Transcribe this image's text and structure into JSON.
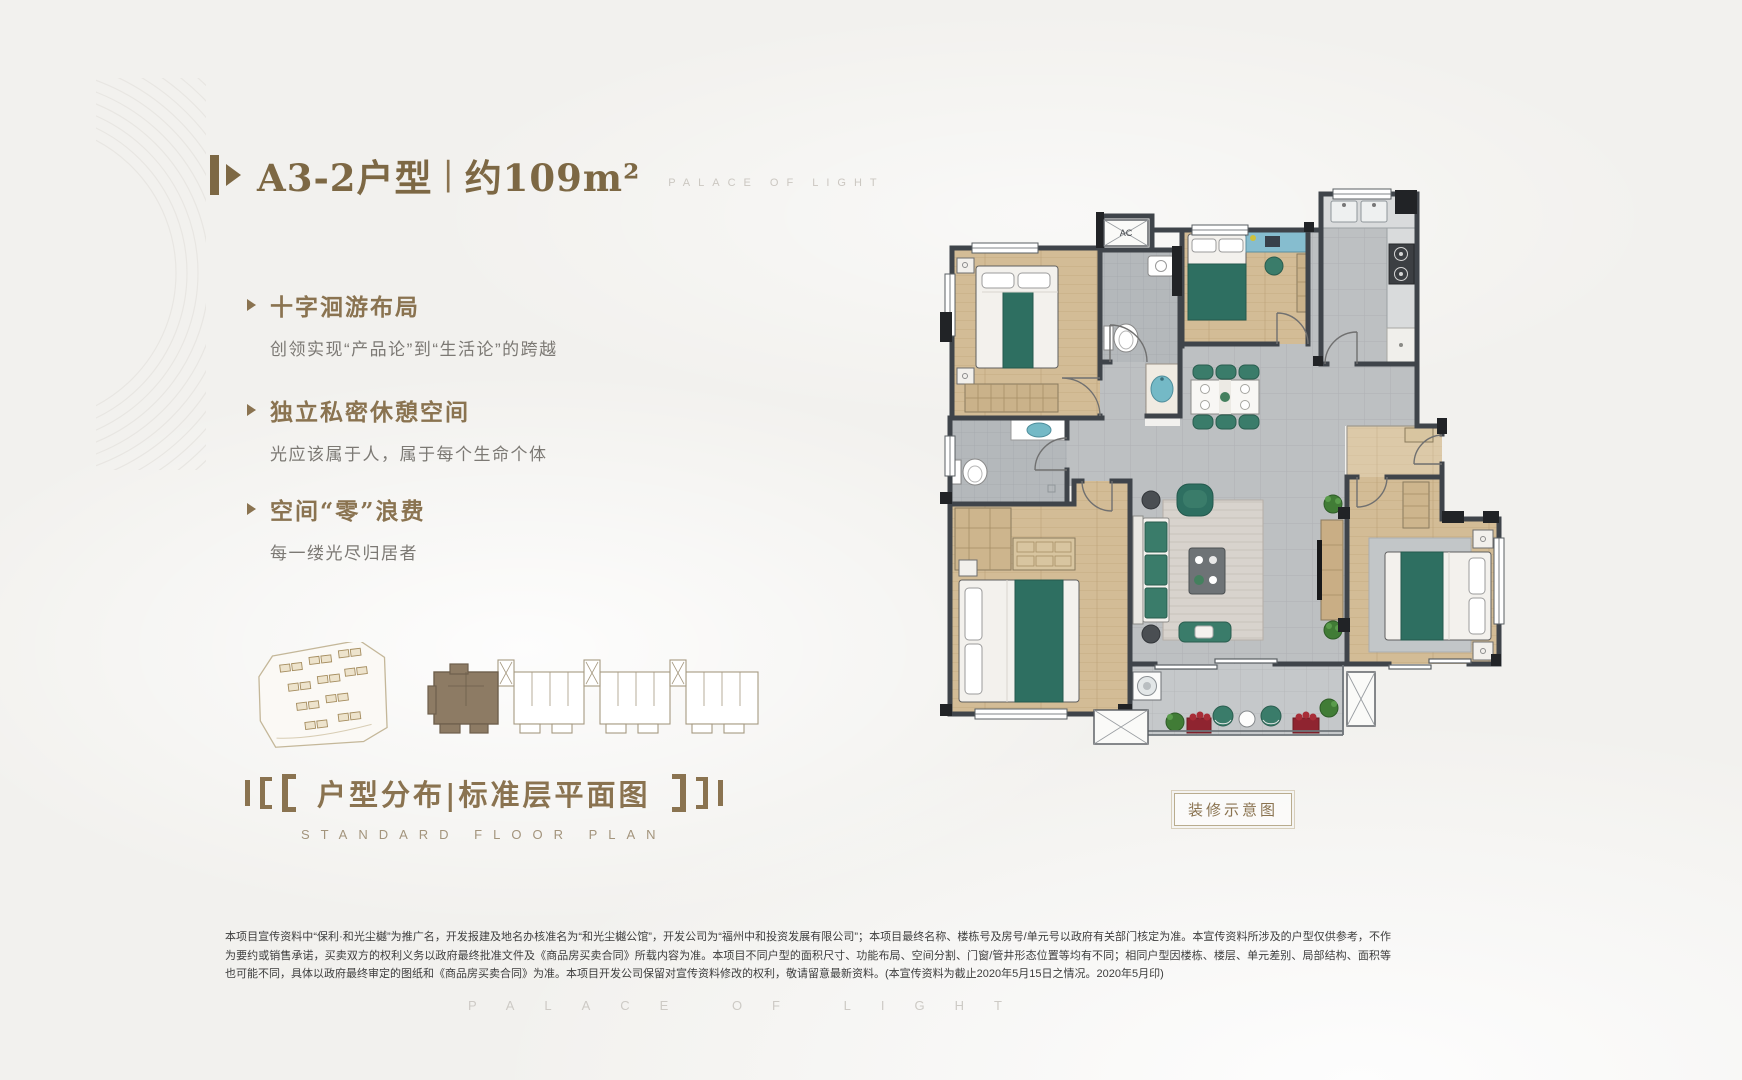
{
  "colors": {
    "accent_gold": "#8a7350",
    "title_gold": "#7d6844",
    "teal_furniture": "#2e6f61",
    "wood_floor": "#d3bc96",
    "tile_floor": "#bdc0c2",
    "wall_gray": "#3f444a",
    "highlight_unit_brown": "#8d7b64",
    "counter_blue": "#86bdcf",
    "planter_red": "#8f2430",
    "background": "#f2f1ee"
  },
  "header": {
    "unit_name": "A3-2户型",
    "divider": "|",
    "area": "约109m²",
    "brand_caption": "PALACE OF LIGHT"
  },
  "features": [
    {
      "title": "十字洄游布局",
      "desc": "创领实现“产品论”到“生活论”的跨越"
    },
    {
      "title": "独立私密休憩空间",
      "desc": "光应该属于人，属于每个生命个体"
    },
    {
      "title": "空间“零”浪费",
      "desc": "每一缕光尽归居者"
    }
  ],
  "section_heading": {
    "title_cn": "户型分布|标准层平面图",
    "title_en": "STANDARD FLOOR PLAN"
  },
  "floor_plan": {
    "decoration_label": "装修示意图",
    "ac_label": "AC"
  },
  "disclaimer": {
    "text": "本项目宣传资料中“保利·和光尘樾”为推广名，开发报建及地名办核准名为“和光尘樾公馆”，开发公司为“福州中和投资发展有限公司”；本项目最终名称、楼栋号及房号/单元号以政府有关部门核定为准。本宣传资料所涉及的户型仅供参考，不作为要约或销售承诺，买卖双方的权利义务以政府最终批准文件及《商品房买卖合同》所载内容为准。本项目不同户型的面积尺寸、功能布局、空间分割、门窗/管井形态位置等均有不同；相同户型因楼栋、楼层、单元差别、局部结构、面积等也可能不同，具体以政府最终审定的图纸和《商品房买卖合同》为准。本项目开发公司保留对宣传资料修改的权利，敬请留意最新资料。(本宣传资料为截止2020年5月15日之情况。2020年5月印)"
  },
  "footer": {
    "watermark": "PALACE OF LIGHT"
  }
}
